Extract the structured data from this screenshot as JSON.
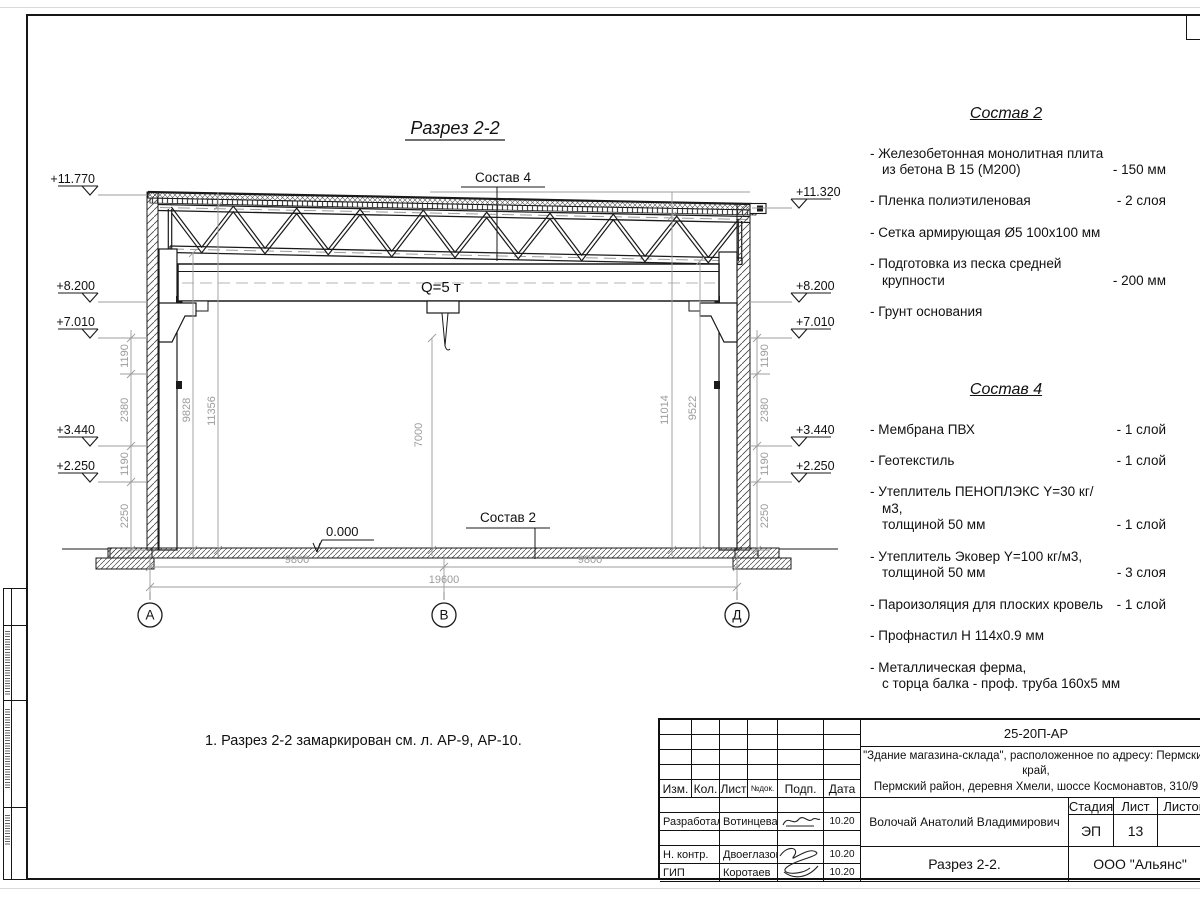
{
  "drawing": {
    "title": "Разрез 2-2",
    "sostav4_label": "Состав 4",
    "sostav2_label": "Состав 2",
    "crane_label": "Q=5 т",
    "zero_mark": "0.000",
    "elevations_left": [
      "+11.770",
      "+8.200",
      "+7.010",
      "+3.440",
      "+2.250"
    ],
    "elevations_right": [
      "+11.320",
      "+8.200",
      "+7.010",
      "+3.440",
      "+2.250"
    ],
    "chain_dims": [
      "1190",
      "2380",
      "1190",
      "2250"
    ],
    "inner_dims": {
      "d9828": "9828",
      "d11356": "11356",
      "d7000": "7000",
      "d11014": "11014",
      "d9522": "9522"
    },
    "bottom_dims": {
      "left": "9800",
      "right": "9800",
      "total": "19600"
    },
    "axes": [
      "А",
      "В",
      "Д"
    ]
  },
  "note": "1. Разрез 2-2 замаркирован см. л. АР-9, АР-10.",
  "sostav2": {
    "title": "Состав 2",
    "items": [
      {
        "name": "- Железобетонная  монолитная плита\nиз бетона В 15 (М200)",
        "qty": "- 150 мм"
      },
      {
        "name": "- Пленка полиэтиленовая",
        "qty": "-  2 слоя"
      },
      {
        "name": "- Сетка армирующая Ø5 100х100 мм",
        "qty": ""
      },
      {
        "name": "- Подготовка из песка средней\nкрупности",
        "qty": "- 200 мм"
      },
      {
        "name": "- Грунт основания",
        "qty": ""
      }
    ]
  },
  "sostav4": {
    "title": "Состав 4",
    "items": [
      {
        "name": "- Мембрана ПВХ",
        "qty": "- 1 слой"
      },
      {
        "name": "- Геотекстиль",
        "qty": "- 1 слой"
      },
      {
        "name": "- Утеплитель ПЕНОПЛЭКС Y=30 кг/м3,\nтолщиной 50 мм",
        "qty": "- 1 слой"
      },
      {
        "name": "- Утеплитель Эковер Y=100 кг/м3,\nтолщиной 50 мм",
        "qty": "- 3 слоя"
      },
      {
        "name": "- Пароизоляция для плоских кровель",
        "qty": "- 1 слой"
      },
      {
        "name": "- Профнастил Н 114х0.9 мм",
        "qty": ""
      },
      {
        "name": "- Металлическая ферма,\nс торца балка - проф. труба 160х5 мм",
        "qty": ""
      }
    ]
  },
  "titleblock": {
    "doc_number": "25-20П-АР",
    "project_line1": "\"Здание магазина-склада\", расположенное по адресу: Пермский край,",
    "project_line2": "Пермский район, деревня Хмели, шоссе Космонавтов, 310/9",
    "cols": {
      "izm": "Изм.",
      "kol": "Кол.",
      "list": "Лист",
      "ndok": "№док.",
      "podp": "Подп.",
      "data": "Дата"
    },
    "rows": [
      {
        "role": "Разработал",
        "name": "Вотинцева",
        "date": "10.20"
      },
      {
        "role": "Н. контр.",
        "name": "Двоеглазов",
        "date": "10.20"
      },
      {
        "role": "ГИП",
        "name": "Коротаев",
        "date": "10.20"
      }
    ],
    "supervisor": "Волочай Анатолий Владимирович",
    "stage_label": "Стадия",
    "sheet_label": "Лист",
    "sheets_label": "Листов",
    "stage_value": "ЭП",
    "sheet_value": "13",
    "drawing_title": "Разрез 2-2.",
    "company": "ООО \"Альянс\""
  },
  "colors": {
    "line": "#1a1a1a",
    "dim": "#9c9c9c"
  }
}
